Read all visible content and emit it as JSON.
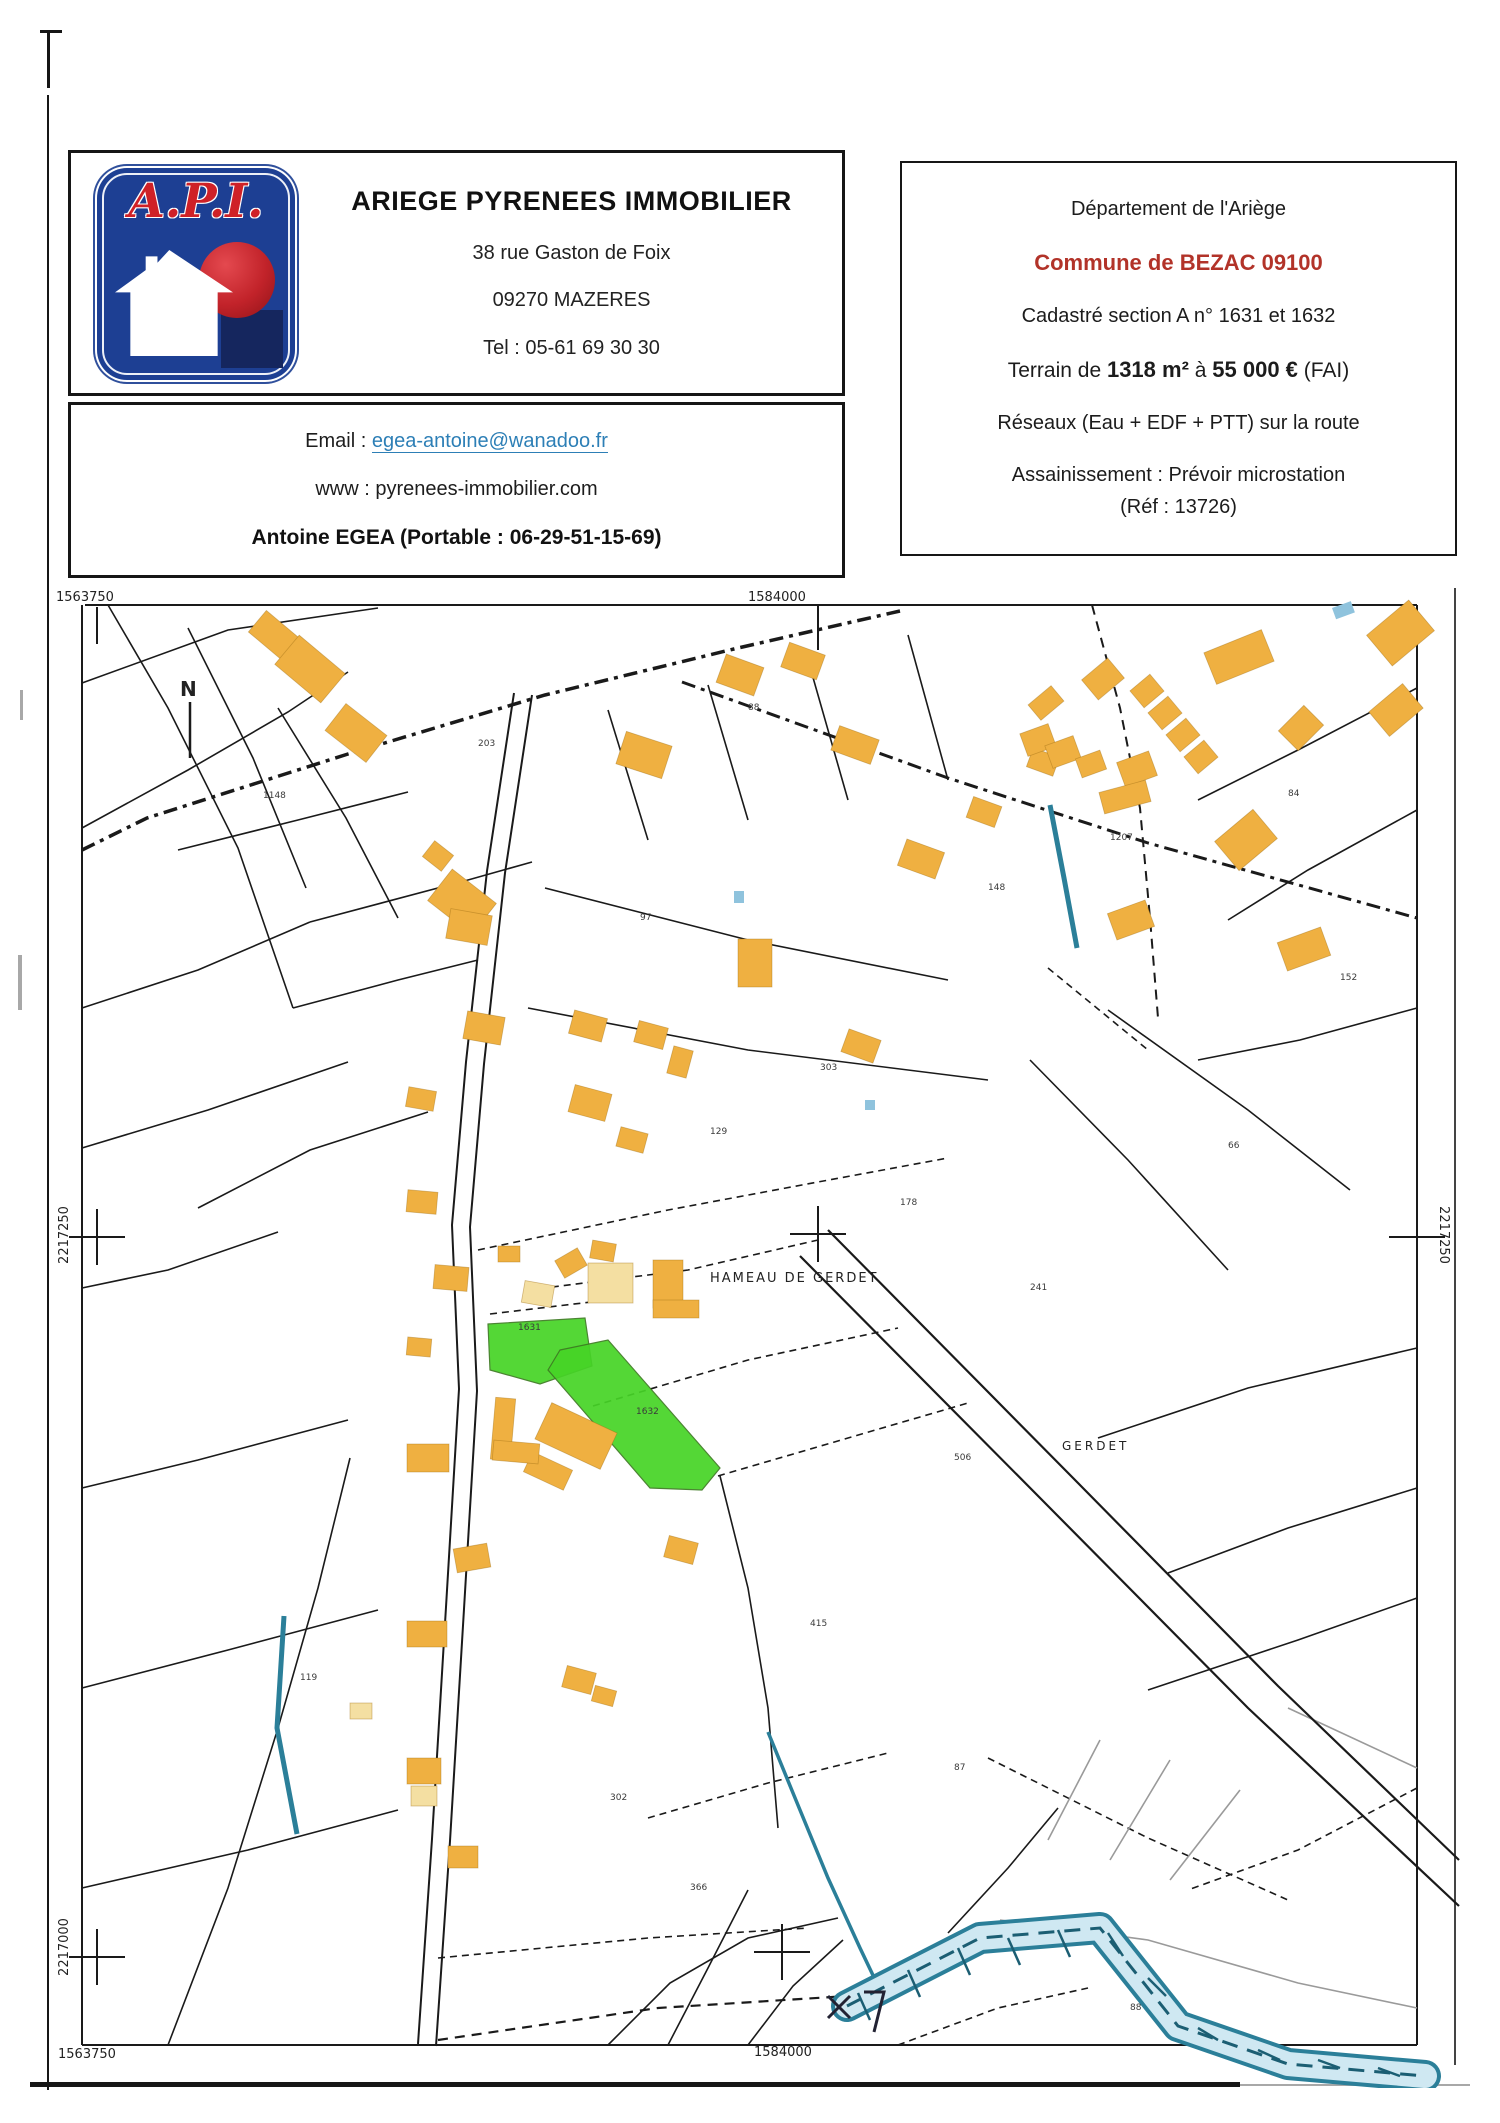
{
  "header": {
    "agency": {
      "logo_text": "A.P.I.",
      "name": "ARIEGE PYRENEES IMMOBILIER",
      "address": "38 rue Gaston de Foix",
      "city": "09270 MAZERES",
      "phone": "Tel : 05-61 69 30 30"
    },
    "contact": {
      "email_label": "Email :",
      "email": "egea-antoine@wanadoo.fr",
      "www_label": "www :",
      "www": "pyrenees-immobilier.com",
      "agent": "Antoine EGEA (Portable : 06-29-51-15-69)"
    },
    "property": {
      "department": "Département de l'Ariège",
      "commune": "Commune de BEZAC 09100",
      "cadastre": "Cadastré section A n° 1631 et 1632",
      "terrain_prefix": "Terrain de ",
      "terrain_area": "1318 m²",
      "terrain_mid": " à ",
      "terrain_price": "55 000 €",
      "terrain_suffix": " (FAI)",
      "networks": "Réseaux (Eau + EDF + PTT)  sur la route",
      "sanitation": "Assainissement : Prévoir microstation",
      "reference": "(Réf : 13726)"
    }
  },
  "map": {
    "colors": {
      "building": "#efb041",
      "building_light": "#f4dfa2",
      "building_edge": "rgba(160,110,20,0.45)",
      "highlight": "#46d426",
      "highlight_edge": "#3d7a22",
      "water": "#2b7f99",
      "water_light": "#cfe8f2",
      "water_dark": "#1b5e73",
      "line": "#1a1a1a",
      "gray": "#9a9a9a"
    },
    "frame": [
      [
        37,
        17,
        1369,
        17,
        2
      ],
      [
        34,
        17,
        34,
        1457,
        2
      ],
      [
        34,
        1457,
        1369,
        1457,
        2
      ],
      [
        1369,
        17,
        1369,
        1457,
        2
      ],
      [
        1407,
        0,
        1407,
        1477,
        2,
        "#444444"
      ]
    ],
    "ticks": [
      [
        49,
        19,
        49,
        56
      ],
      [
        770,
        17,
        770,
        62
      ]
    ],
    "crosses": [
      [
        770,
        646
      ],
      [
        49,
        649
      ],
      [
        1369,
        649
      ],
      [
        49,
        1369
      ],
      [
        734,
        1364
      ]
    ],
    "north_line": [
      142,
      114,
      142,
      170
    ],
    "survey_x": [
      [
        780,
        1408,
        802,
        1430
      ],
      [
        802,
        1408,
        780,
        1430
      ]
    ],
    "survey_flag": "816,1404 836,1404 826,1444",
    "roads": [
      {
        "p": "34,262 99,230 300,166 497,107 690,60 852,23",
        "s": "dashdot",
        "w": 3.5
      },
      {
        "p": "634,94 900,190 1100,255 1369,330",
        "s": "dashdot",
        "w": 3
      },
      {
        "p": "484,107 457,285 436,476 422,639 429,803 416,1021 402,1253 388,1458",
        "s": "solid",
        "w": 2
      },
      {
        "p": "466,105 439,283 418,474 404,637 411,801 398,1019 384,1251 370,1456",
        "s": "solid",
        "w": 2
      },
      {
        "p": "752,668 1000,918 1200,1120 1411,1318",
        "s": "solid",
        "w": 2.2
      },
      {
        "p": "780,642 1030,895 1230,1098 1411,1272",
        "s": "solid",
        "w": 2.2
      },
      {
        "p": "390,1452 610,1420 800,1408",
        "s": "dashed",
        "w": 2.2
      },
      {
        "p": "1044,17 1072,120 1092,220 1102,330 1110,430",
        "s": "dashed",
        "w": 2
      }
    ],
    "parcel_lines": [
      {
        "p": "60,17 120,120 190,260 245,420"
      },
      {
        "p": "140,40 205,170 258,300"
      },
      {
        "p": "230,120 298,230 350,330"
      },
      {
        "p": "34,95 180,42 330,20"
      },
      {
        "p": "34,240 140,182 240,124 300,84"
      },
      {
        "p": "34,420 150,382 262,334"
      },
      {
        "p": "34,560 160,522 300,474"
      },
      {
        "p": "150,620 262,562 380,524"
      },
      {
        "p": "34,700 120,682 230,644"
      },
      {
        "p": "130,262 250,232 360,204"
      },
      {
        "p": "245,420 350,392 430,372"
      },
      {
        "p": "262,334 420,292 484,274"
      },
      {
        "p": "497,300 700,352 900,392"
      },
      {
        "p": "480,420 700,462 940,492"
      },
      {
        "p": "560,122 600,252"
      },
      {
        "p": "660,97 700,232"
      },
      {
        "p": "760,72 800,212"
      },
      {
        "p": "860,47 900,192"
      },
      {
        "p": "1369,100 1250,162 1150,212"
      },
      {
        "p": "1369,222 1260,282 1180,332"
      },
      {
        "p": "1369,420 1252,452 1150,472"
      },
      {
        "p": "1060,422 1200,522 1302,602"
      },
      {
        "p": "982,472 1080,572 1180,682"
      },
      {
        "p": "120,1457 180,1300 230,1140 270,1000 302,870"
      },
      {
        "p": "34,900 150,872 300,832"
      },
      {
        "p": "34,1100 180,1062 330,1022"
      },
      {
        "p": "34,1300 200,1262 350,1222"
      },
      {
        "p": "560,1457 622,1395 700,1350 790,1330"
      },
      {
        "p": "900,1345 960,1280 1010,1220"
      },
      {
        "p": "1369,1010 1250,1052 1100,1102"
      },
      {
        "p": "620,1457 660,1380 700,1302"
      },
      {
        "p": "1369,760 1200,800 1050,850"
      },
      {
        "p": "1369,900 1240,940 1120,985"
      },
      {
        "p": "700,1457 745,1398 795,1352"
      },
      {
        "p": "672,888 700,1000 720,1120 730,1240"
      },
      {
        "p": "430,662 620,622 770,594 900,570",
        "d": 1
      },
      {
        "p": "480,702 640,682 770,652",
        "d": 1
      },
      {
        "p": "442,726 560,712",
        "d": 1
      },
      {
        "p": "545,818 700,772 850,740",
        "d": 1
      },
      {
        "p": "670,888 800,850 920,815",
        "d": 1
      },
      {
        "p": "940,1170 1100,1250 1240,1312",
        "d": 1
      },
      {
        "p": "1369,1200 1250,1262 1140,1302",
        "d": 1
      },
      {
        "p": "390,1370 600,1350 760,1340",
        "d": 1
      },
      {
        "p": "1000,380 1100,462",
        "d": 1
      },
      {
        "p": "850,1457 950,1420 1040,1400",
        "d": 1
      },
      {
        "p": "600,1230 720,1195 840,1165",
        "d": 1
      },
      {
        "p": "1000,1252 1052,1152",
        "g": 1
      },
      {
        "p": "1062,1272 1122,1172",
        "g": 1
      },
      {
        "p": "1122,1292 1192,1202",
        "g": 1
      },
      {
        "p": "952,1332 1100,1352 1250,1395 1369,1420",
        "g": 1
      },
      {
        "p": "1240,1120 1369,1180",
        "g": 1
      }
    ],
    "buildings": [
      [
        204,
        34,
        46,
        28,
        40,
        "o"
      ],
      [
        232,
        62,
        60,
        38,
        40,
        "o"
      ],
      [
        282,
        128,
        52,
        34,
        38,
        "o"
      ],
      [
        378,
        258,
        24,
        20,
        38,
        "o"
      ],
      [
        386,
        294,
        56,
        40,
        38,
        "o"
      ],
      [
        572,
        150,
        48,
        34,
        18,
        "o"
      ],
      [
        672,
        72,
        40,
        30,
        20,
        "o"
      ],
      [
        736,
        60,
        38,
        26,
        20,
        "o"
      ],
      [
        786,
        144,
        42,
        26,
        20,
        "o"
      ],
      [
        853,
        257,
        40,
        28,
        20,
        "o"
      ],
      [
        921,
        213,
        30,
        22,
        20,
        "o"
      ],
      [
        981,
        164,
        28,
        20,
        20,
        "o"
      ],
      [
        1325,
        25,
        55,
        40,
        -40,
        "o"
      ],
      [
        1160,
        52,
        62,
        34,
        -22,
        "o"
      ],
      [
        983,
        105,
        30,
        20,
        -40,
        "o"
      ],
      [
        1038,
        78,
        34,
        26,
        -40,
        "o"
      ],
      [
        1086,
        92,
        26,
        22,
        -40,
        "o"
      ],
      [
        1104,
        114,
        26,
        22,
        -40,
        "o"
      ],
      [
        1122,
        136,
        26,
        22,
        -40,
        "o"
      ],
      [
        1140,
        158,
        26,
        22,
        -40,
        "o"
      ],
      [
        975,
        140,
        30,
        24,
        -20,
        "o"
      ],
      [
        1000,
        152,
        30,
        24,
        -20,
        "o"
      ],
      [
        1030,
        166,
        26,
        20,
        -20,
        "o"
      ],
      [
        1072,
        168,
        34,
        26,
        -20,
        "o"
      ],
      [
        1235,
        126,
        36,
        28,
        -45,
        "o"
      ],
      [
        1326,
        106,
        44,
        32,
        -40,
        "o"
      ],
      [
        1173,
        233,
        50,
        38,
        -40,
        "o"
      ],
      [
        1053,
        198,
        48,
        22,
        -15,
        "o"
      ],
      [
        1063,
        318,
        40,
        28,
        -20,
        "o"
      ],
      [
        1233,
        346,
        46,
        30,
        -20,
        "o"
      ],
      [
        400,
        324,
        42,
        30,
        10,
        "o"
      ],
      [
        417,
        426,
        38,
        28,
        10,
        "o"
      ],
      [
        359,
        501,
        28,
        20,
        10,
        "o"
      ],
      [
        523,
        426,
        34,
        24,
        15,
        "o"
      ],
      [
        588,
        436,
        30,
        22,
        15,
        "o"
      ],
      [
        523,
        501,
        38,
        28,
        15,
        "o"
      ],
      [
        570,
        542,
        28,
        20,
        15,
        "o"
      ],
      [
        622,
        460,
        20,
        28,
        15,
        "o"
      ],
      [
        690,
        351,
        34,
        48,
        0,
        "o"
      ],
      [
        796,
        446,
        34,
        24,
        20,
        "o"
      ],
      [
        359,
        603,
        30,
        22,
        5,
        "o"
      ],
      [
        386,
        678,
        34,
        24,
        5,
        "o"
      ],
      [
        543,
        654,
        24,
        18,
        10,
        "o"
      ],
      [
        475,
        695,
        30,
        22,
        10,
        "l"
      ],
      [
        359,
        750,
        24,
        18,
        5,
        "o"
      ],
      [
        540,
        675,
        45,
        40,
        0,
        "l"
      ],
      [
        605,
        672,
        30,
        48,
        0,
        "o"
      ],
      [
        605,
        712,
        46,
        18,
        0,
        "o"
      ],
      [
        510,
        665,
        26,
        20,
        -30,
        "o"
      ],
      [
        450,
        658,
        22,
        16,
        0,
        "o"
      ],
      [
        492,
        828,
        72,
        40,
        25,
        "o"
      ],
      [
        478,
        872,
        44,
        22,
        25,
        "o"
      ],
      [
        445,
        810,
        20,
        62,
        5,
        "o"
      ],
      [
        445,
        854,
        46,
        20,
        5,
        "o"
      ],
      [
        359,
        856,
        42,
        28,
        0,
        "o"
      ],
      [
        407,
        958,
        34,
        24,
        -10,
        "o"
      ],
      [
        618,
        951,
        30,
        22,
        15,
        "o"
      ],
      [
        359,
        1033,
        40,
        26,
        0,
        "o"
      ],
      [
        516,
        1081,
        30,
        22,
        15,
        "o"
      ],
      [
        359,
        1170,
        34,
        26,
        0,
        "o"
      ],
      [
        363,
        1198,
        26,
        20,
        0,
        "l"
      ],
      [
        400,
        1258,
        30,
        22,
        0,
        "o"
      ],
      [
        302,
        1115,
        22,
        16,
        0,
        "l"
      ],
      [
        545,
        1100,
        22,
        16,
        15,
        "o"
      ]
    ],
    "green_parcels": [
      "440,736 537,730 544,778 492,796 442,782",
      "512,762 560,752 672,880 654,902 602,900 500,782"
    ],
    "water": {
      "stream": "720,1144 745,1205 780,1290 812,1360 832,1402",
      "band": "799,1418 932,1350 1052,1340 1130,1438 1240,1476 1377,1488",
      "hatch": [
        [
          810,
          1405,
          822,
          1432
        ],
        [
          860,
          1382,
          872,
          1409
        ],
        [
          910,
          1360,
          922,
          1387
        ],
        [
          960,
          1350,
          972,
          1377
        ],
        [
          1010,
          1342,
          1022,
          1369
        ],
        [
          1060,
          1345,
          1075,
          1368
        ],
        [
          1100,
          1390,
          1118,
          1408
        ],
        [
          1150,
          1440,
          1170,
          1452
        ],
        [
          1210,
          1462,
          1232,
          1472
        ],
        [
          1270,
          1472,
          1292,
          1480
        ],
        [
          1330,
          1480,
          1352,
          1488
        ]
      ],
      "segments": [
        "236,1028 229,1140 249,1246",
        "1002,217 1016,290 1029,360"
      ],
      "dots": [
        [
          686,
          303,
          10,
          12,
          0
        ],
        [
          817,
          512,
          10,
          10,
          0
        ],
        [
          1284,
          20,
          20,
          12,
          -20
        ]
      ]
    },
    "parcel_numbers": [
      {
        "x": 215,
        "y": 210,
        "t": "1148"
      },
      {
        "x": 430,
        "y": 158,
        "t": "203"
      },
      {
        "x": 700,
        "y": 122,
        "t": "88"
      },
      {
        "x": 940,
        "y": 302,
        "t": "148"
      },
      {
        "x": 1240,
        "y": 208,
        "t": "84"
      },
      {
        "x": 1292,
        "y": 392,
        "t": "152"
      },
      {
        "x": 1062,
        "y": 252,
        "t": "1207"
      },
      {
        "x": 592,
        "y": 332,
        "t": "97"
      },
      {
        "x": 662,
        "y": 546,
        "t": "129"
      },
      {
        "x": 772,
        "y": 482,
        "t": "303"
      },
      {
        "x": 852,
        "y": 617,
        "t": "178"
      },
      {
        "x": 982,
        "y": 702,
        "t": "241"
      },
      {
        "x": 470,
        "y": 742,
        "t": "1631"
      },
      {
        "x": 588,
        "y": 826,
        "t": "1632"
      },
      {
        "x": 906,
        "y": 872,
        "t": "506"
      },
      {
        "x": 762,
        "y": 1038,
        "t": "415"
      },
      {
        "x": 562,
        "y": 1212,
        "t": "302"
      },
      {
        "x": 906,
        "y": 1182,
        "t": "87"
      },
      {
        "x": 1082,
        "y": 1422,
        "t": "88"
      },
      {
        "x": 642,
        "y": 1302,
        "t": "366"
      },
      {
        "x": 252,
        "y": 1092,
        "t": "119"
      },
      {
        "x": 1180,
        "y": 560,
        "t": "66"
      }
    ],
    "map_texts": [
      {
        "t": "1563750",
        "x": 8,
        "y": 13,
        "s": 13
      },
      {
        "t": "1584000",
        "x": 700,
        "y": 13,
        "s": 13
      },
      {
        "t": "2217250",
        "x": 20,
        "y": 647,
        "s": 13,
        "r": -90
      },
      {
        "t": "2217250",
        "x": 1392,
        "y": 647,
        "s": 13,
        "r": 90
      },
      {
        "t": "2217000",
        "x": 20,
        "y": 1359,
        "s": 13,
        "r": -90
      },
      {
        "t": "1563750",
        "x": 10,
        "y": 1470,
        "s": 13
      },
      {
        "t": "1584000",
        "x": 706,
        "y": 1468,
        "s": 13
      },
      {
        "t": "HAMEAU DE GERDET",
        "x": 662,
        "y": 694,
        "s": 13,
        "ls": 2
      },
      {
        "t": "GERDET",
        "x": 1014,
        "y": 862,
        "s": 12,
        "ls": 3
      },
      {
        "t": "N",
        "x": 132,
        "y": 108,
        "s": 20,
        "b": 1
      }
    ]
  }
}
